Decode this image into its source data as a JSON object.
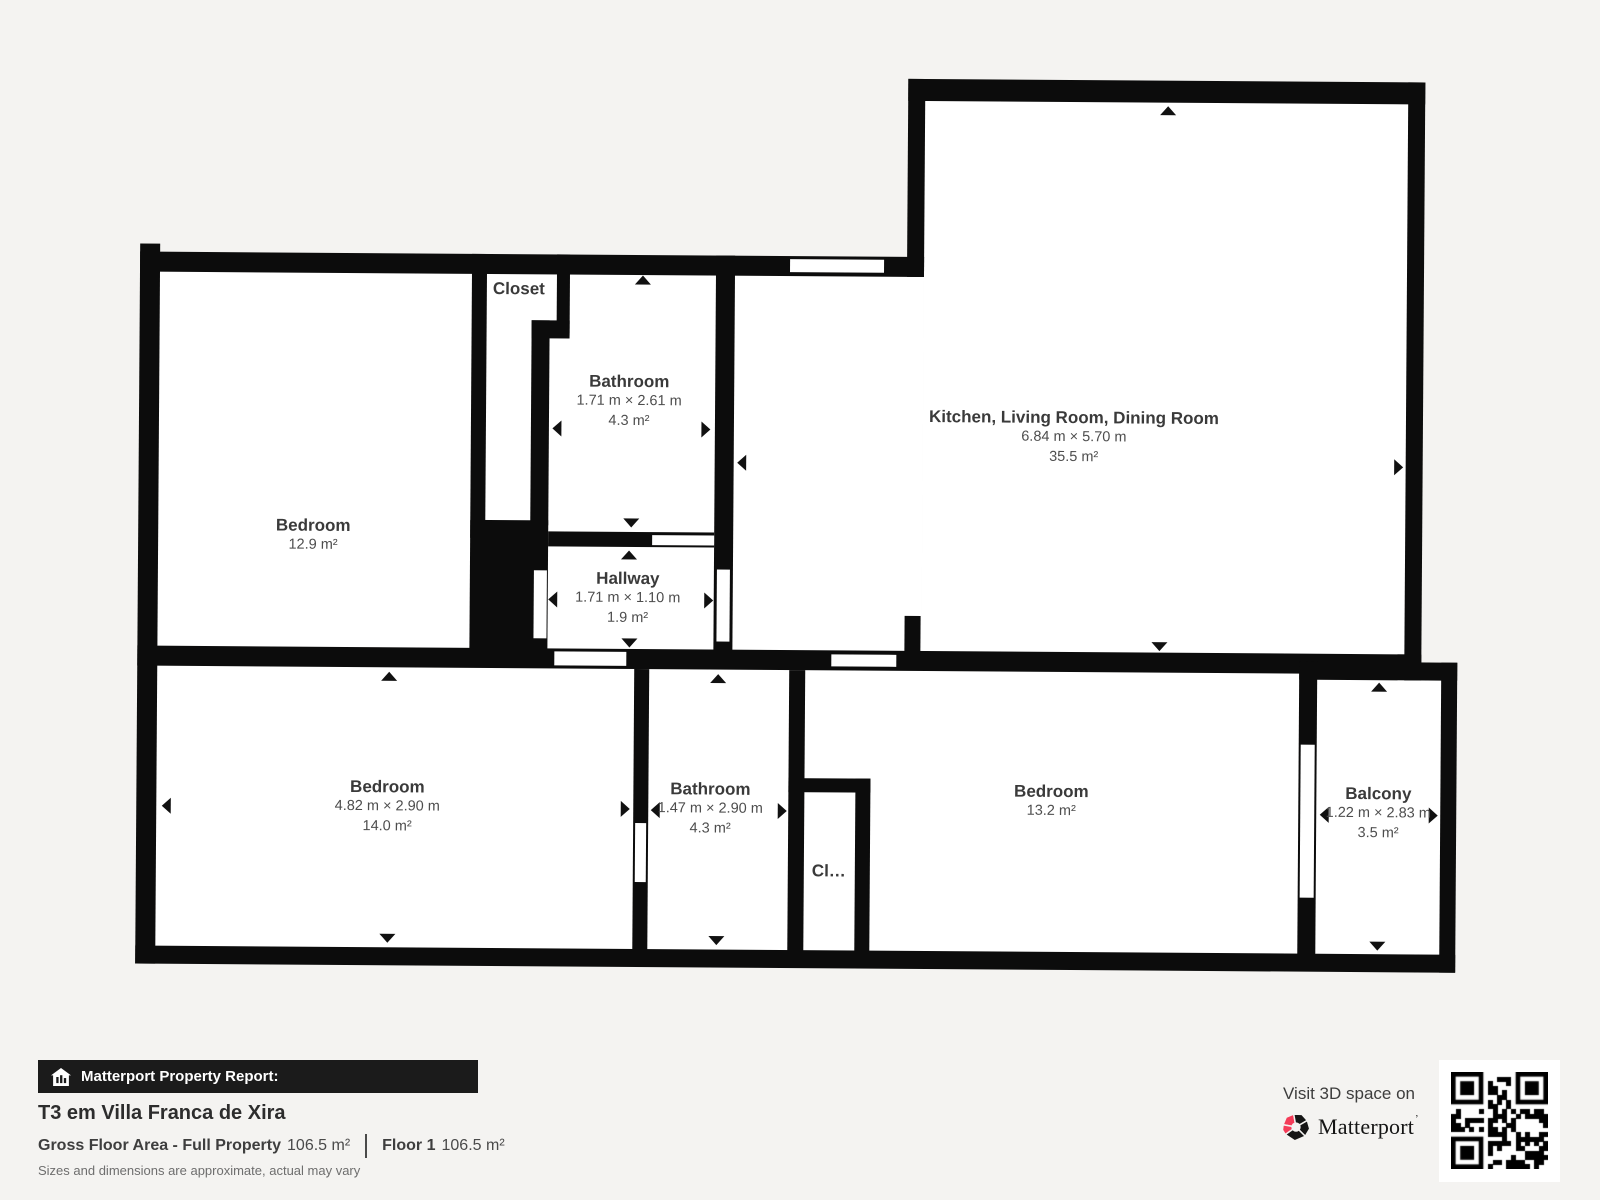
{
  "plan": {
    "rooms": [
      {
        "id": "bedroom-nw",
        "name": "Bedroom",
        "area": "12.9 m²"
      },
      {
        "id": "closet-n",
        "name": "Closet"
      },
      {
        "id": "bathroom-n",
        "name": "Bathroom",
        "dims": "1.71 m × 2.61 m",
        "area": "4.3 m²"
      },
      {
        "id": "hallway",
        "name": "Hallway",
        "dims": "1.71 m × 1.10 m",
        "area": "1.9 m²"
      },
      {
        "id": "kitchen-living-dining",
        "name": "Kitchen, Living Room, Dining Room",
        "dims": "6.84 m × 5.70 m",
        "area": "35.5 m²"
      },
      {
        "id": "bedroom-sw",
        "name": "Bedroom",
        "dims": "4.82 m × 2.90 m",
        "area": "14.0 m²"
      },
      {
        "id": "bathroom-s",
        "name": "Bathroom",
        "dims": "1.47 m × 2.90 m",
        "area": "4.3 m²"
      },
      {
        "id": "closet-s",
        "name": "Cl…"
      },
      {
        "id": "bedroom-se",
        "name": "Bedroom",
        "area": "13.2 m²"
      },
      {
        "id": "balcony",
        "name": "Balcony",
        "dims": "1.22 m × 2.83 m",
        "area": "3.5 m²"
      }
    ]
  },
  "footer": {
    "report_label": "Matterport Property Report:",
    "property_title": "T3 em Villa Franca de Xira",
    "gross_floor_label": "Gross Floor Area - Full Property",
    "gross_floor_value": "106.5 m²",
    "floor_label": "Floor 1",
    "floor_value": "106.5 m²",
    "disclaimer": "Sizes and dimensions are approximate, actual may vary",
    "visit_label": "Visit 3D space on",
    "brand": "Matterport",
    "brand_mark": "’"
  },
  "colors": {
    "wall": "#0c0c0c",
    "background": "#f4f3f1",
    "floor": "#ffffff",
    "accent_pink": "#f43b58"
  }
}
